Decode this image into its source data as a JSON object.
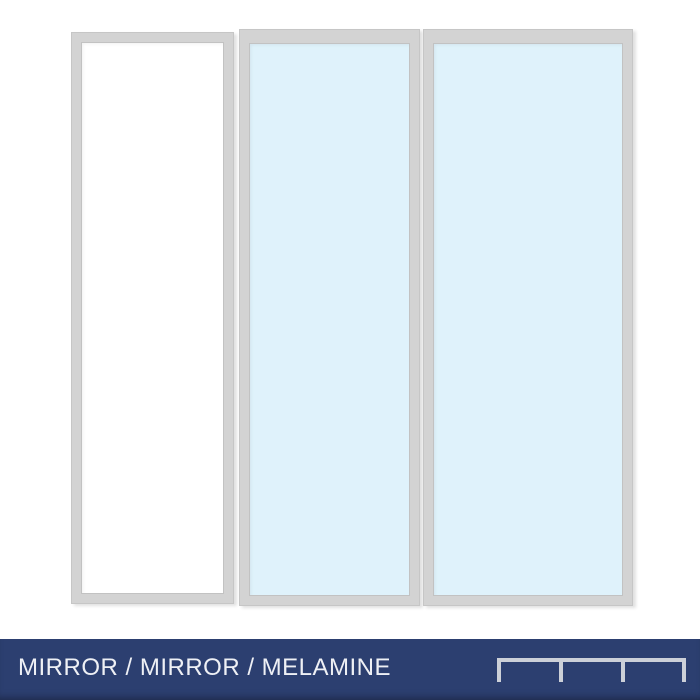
{
  "preview": {
    "panels": [
      {
        "id": "door-1",
        "material": "Melamine",
        "fill": "#ffffff"
      },
      {
        "id": "door-2",
        "material": "Mirror",
        "fill": "#dff2fb"
      },
      {
        "id": "door-3",
        "material": "Mirror",
        "fill": "#dff2fb"
      }
    ],
    "frame_color": "#d3d3d3"
  },
  "footer": {
    "label": "MIRROR / MIRROR / MELAMINE",
    "bar_color": "#2c3f70",
    "text_color": "#eef0f5",
    "icon": "triple-track-profile-icon",
    "icon_color": "#ccd0d8"
  }
}
